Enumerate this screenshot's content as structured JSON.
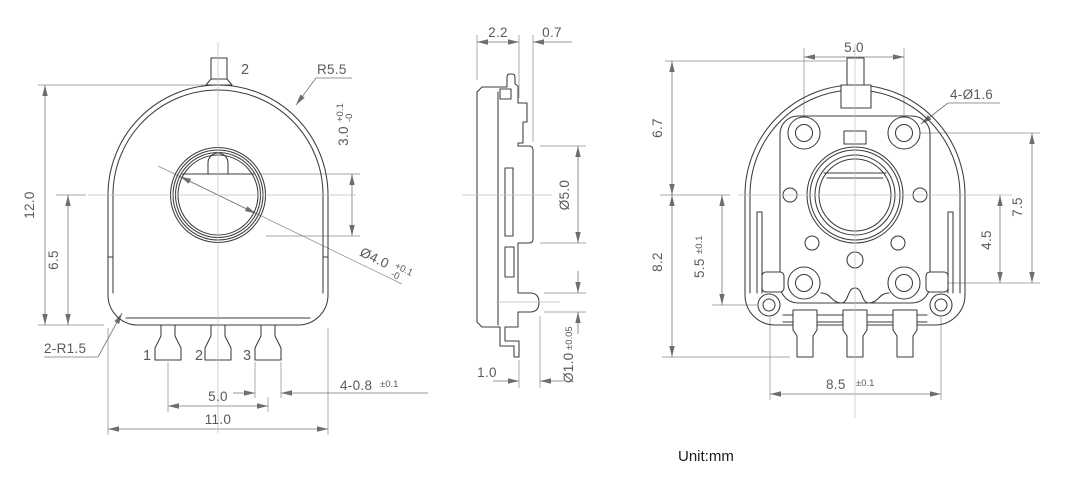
{
  "unit_note": "Unit:mm",
  "front_view": {
    "tab_label": "2",
    "terminal_labels": {
      "t1": "1",
      "t2": "2",
      "t3": "3"
    },
    "dims": {
      "overall_height": "12.0",
      "center_to_base": "6.5",
      "overall_width": "11.0",
      "terminal_pitch": "5.0",
      "top_radius": "R5.5",
      "base_corner_radius": "2-R1.5",
      "terminal_width": "4-0.8",
      "terminal_width_tol": "±0.1",
      "shaft_flat": "3.0",
      "shaft_flat_tol_plus": "+0.1",
      "shaft_flat_tol_minus": "-0",
      "shaft_hole_dia": "Ø4.0",
      "shaft_hole_tol_plus": "+0.1",
      "shaft_hole_tol_minus": "-0"
    }
  },
  "side_view": {
    "dims": {
      "body_thickness": "2.2",
      "boss_height": "0.7",
      "boss_dia": "Ø5.0",
      "lead_bend": "1.0",
      "lead_dia": "Ø1.0",
      "lead_dia_tol": "±0.05"
    }
  },
  "back_view": {
    "dims": {
      "hole_pitch_h": "5.0",
      "mounting_holes": "4-Ø1.6",
      "top_to_center": "6.7",
      "center_to_lead_tip": "8.2",
      "center_to_lug": "5.5",
      "center_to_lug_tol": "±0.1",
      "hole_pitch_v": "7.5",
      "center_to_lower_holes": "4.5",
      "lug_pitch": "8.5",
      "lug_pitch_tol": "±0.1"
    }
  }
}
